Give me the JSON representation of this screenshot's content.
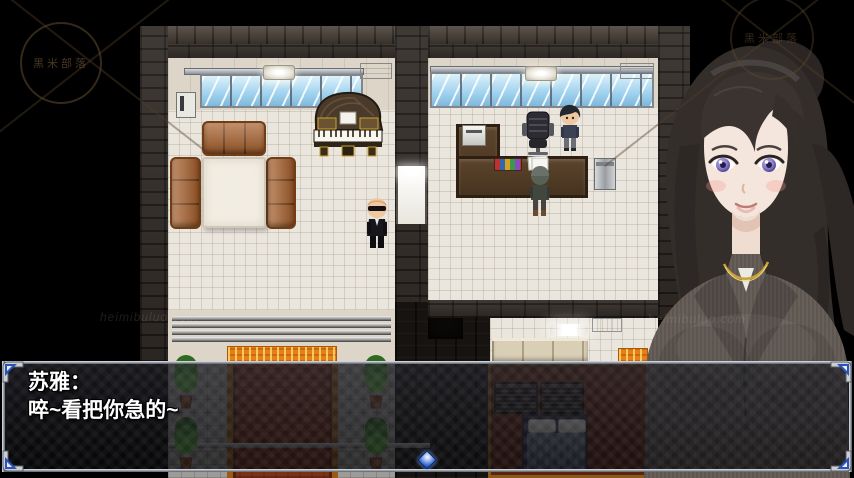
{
  "dialog": {
    "speaker": "苏雅：",
    "line": "啐~看把你急的~"
  },
  "watermark": {
    "logo_text": "黑米部落",
    "url_text": "heimibuluo.com"
  },
  "icons": {
    "continue_indicator": "blue-diamond-cursor",
    "dialog_corner": "blue-arrow-corner-bracket"
  },
  "colors": {
    "background": "#000000",
    "dialog_border_silver": "#c9ced4",
    "dialog_corner_blue": "#2c53b8",
    "window_glass_blue": "#9fd2ee",
    "sofa_leather_brown": "#a8602c",
    "carpet_path_red": "#7c3016",
    "carpet_trim_gold": "#9a5a14",
    "entry_mat_orange": "#e67f1a",
    "floor_tile_white": "#eae6de",
    "ground_tile_gray": "#9c9b97",
    "wall_brick_dark": "#342e29",
    "piano_wood": "#4a3a2c",
    "portrait_hair_brown": "#332d2a",
    "portrait_eye_violet": "#8a7fc8",
    "portrait_suit_gray": "#685f59",
    "portrait_necklace_gold": "#caa33a"
  }
}
